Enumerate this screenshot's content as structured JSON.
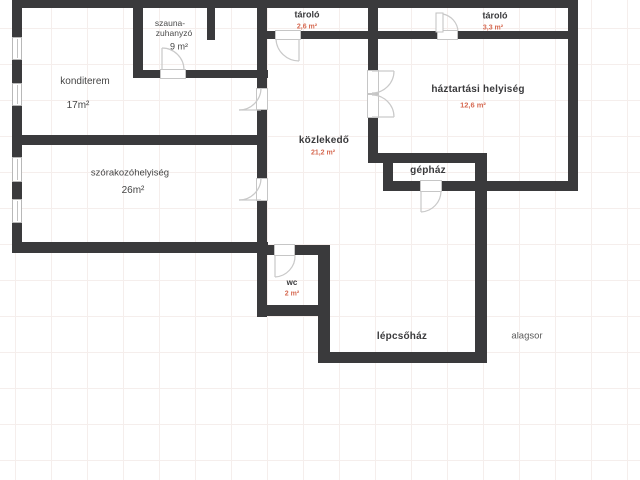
{
  "plan": {
    "floor_label": "alagsor",
    "rooms": {
      "szauna": {
        "name_line1": "szauna-",
        "name_line2": "zuhanyzó",
        "area": "9 m²"
      },
      "konditerem": {
        "name": "konditerem",
        "area": "17m²"
      },
      "szorakozohelyiseg": {
        "name": "szórakozóhelyiség",
        "area": "26m²"
      },
      "tarolo_small": {
        "name": "tároló",
        "area": "2,6 m²"
      },
      "tarolo_large": {
        "name": "tároló",
        "area": "3,3 m²"
      },
      "haztartasi_helyiseg": {
        "name": "háztartási helyiség",
        "area": "12,6 m²"
      },
      "kozlekedo": {
        "name": "közlekedő",
        "area": "21,2 m²"
      },
      "gephaz": {
        "name": "gépház"
      },
      "wc": {
        "name": "wc",
        "area": "2 m²"
      },
      "lepcsohaz": {
        "name": "lépcsőház"
      }
    },
    "colors": {
      "wall": "#3a3a3c",
      "room_label": "#3a3a3c",
      "area_value": "#d66a52",
      "door": "#c9c9c9",
      "grid_line": "#f5eeec"
    }
  }
}
